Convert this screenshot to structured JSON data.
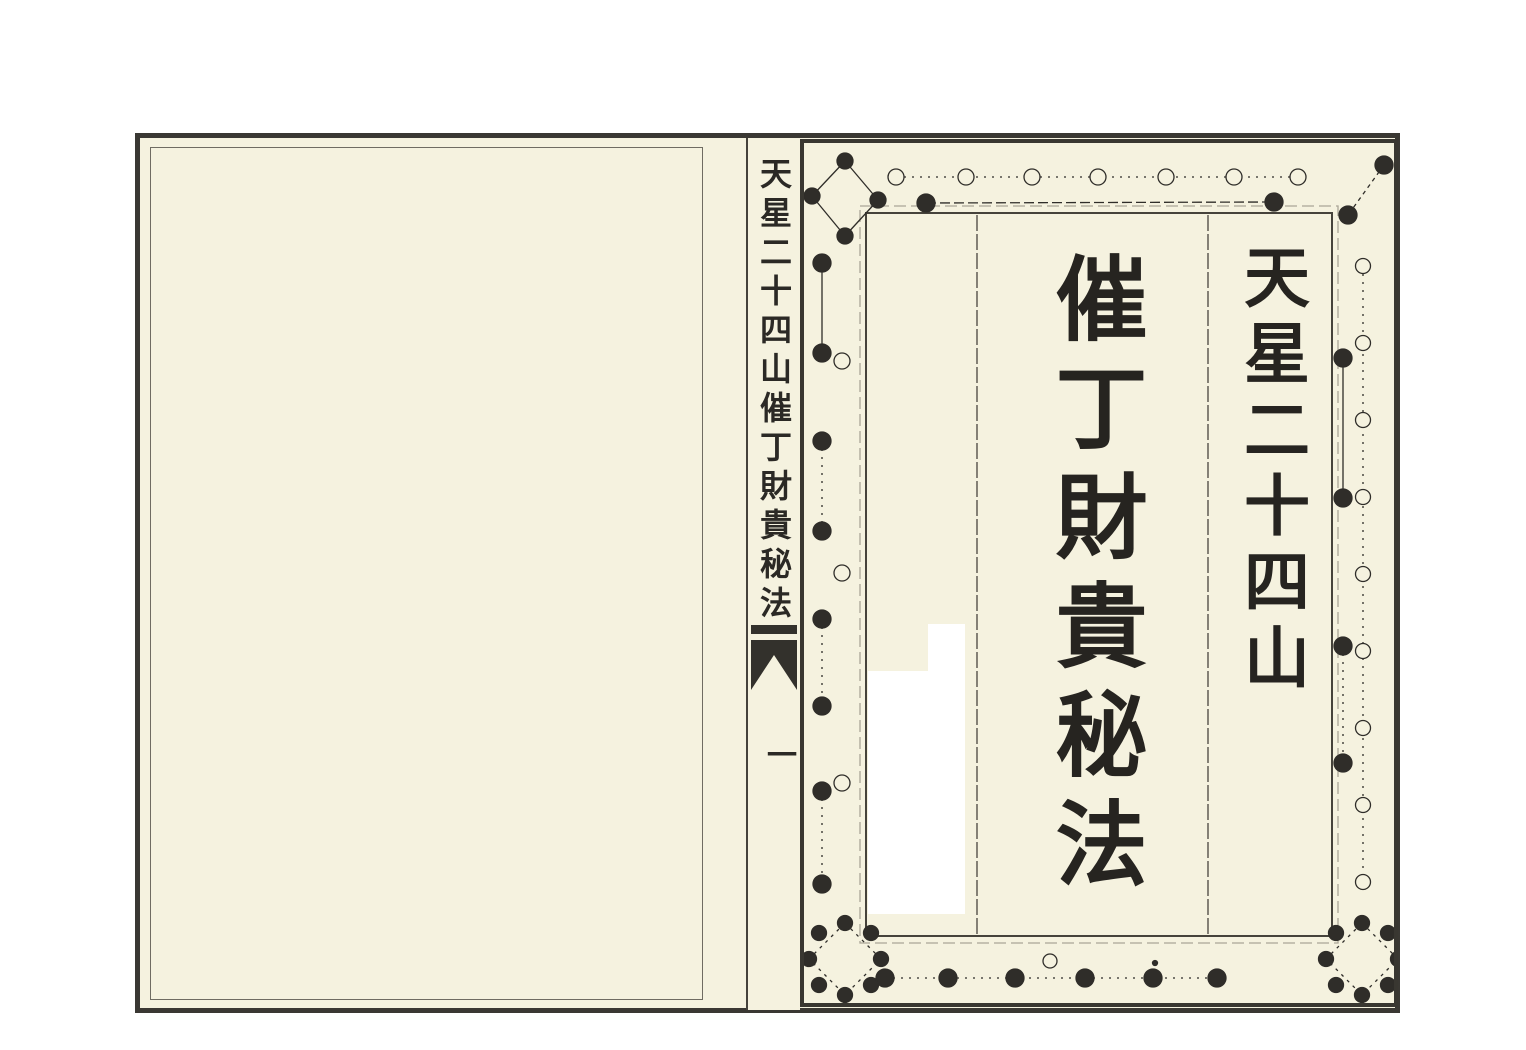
{
  "spine": {
    "title": "天星二十四山催丁財貴秘法",
    "page_number": "一"
  },
  "title_page": {
    "series_title": "天星二十四山",
    "main_title": "催丁財貴秘法"
  },
  "colors": {
    "paper": "#f5f2df",
    "ink": "#2b2925",
    "frame": "#3a3833",
    "patch": "#ffffff"
  }
}
